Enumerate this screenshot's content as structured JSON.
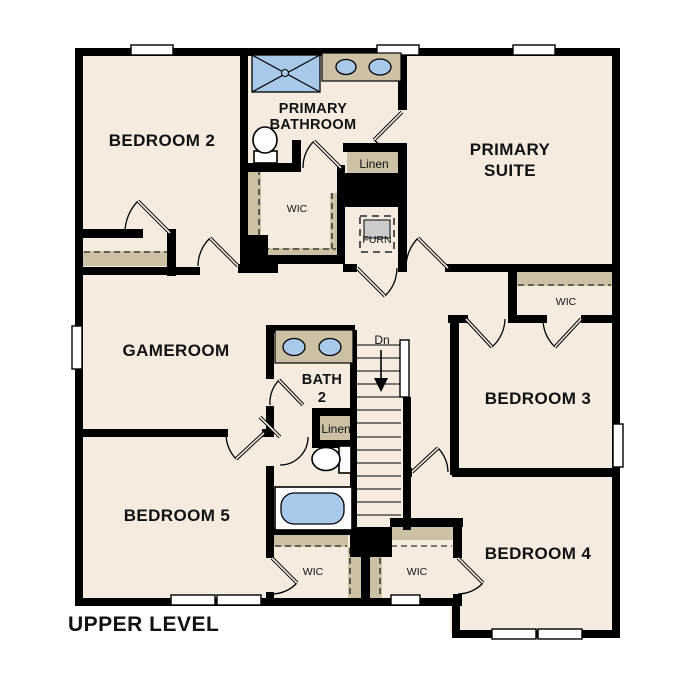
{
  "plan_title": "UPPER LEVEL",
  "colors": {
    "floor": "#f5ecdf",
    "wall": "#000000",
    "closet_shelf": "#cdc1a5",
    "fixture_blue": "#a9c9ea",
    "window_white": "#ffffff"
  },
  "rooms": {
    "bedroom2": "BEDROOM 2",
    "primary_bathroom_1": "PRIMARY",
    "primary_bathroom_2": "BATHROOM",
    "primary_suite_1": "PRIMARY",
    "primary_suite_2": "SUITE",
    "gameroom": "GAMEROOM",
    "bath2_1": "BATH",
    "bath2_2": "2",
    "bedroom3": "BEDROOM 3",
    "bedroom4": "BEDROOM 4",
    "bedroom5": "BEDROOM 5"
  },
  "closets": {
    "linen_upper": "Linen",
    "linen_lower": "Linen",
    "wic_primary": "WIC",
    "wic_bedroom3": "WIC",
    "wic_bottom_left": "WIC",
    "wic_bottom_right": "WIC"
  },
  "utility": {
    "furnace": "FURN"
  },
  "stairs": {
    "direction_label": "Dn"
  }
}
